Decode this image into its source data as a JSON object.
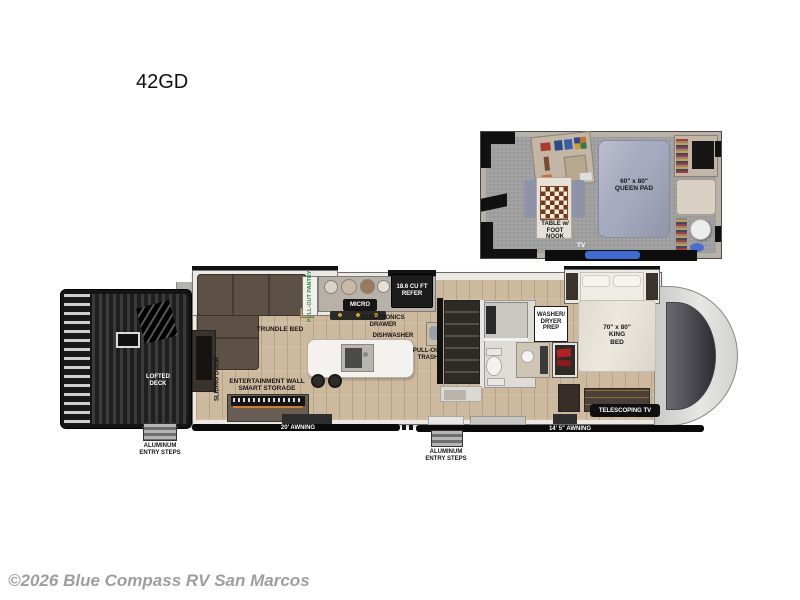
{
  "page": {
    "title": "42GD",
    "watermark": "©2026 Blue Compass RV San Marcos"
  },
  "loft": {
    "queen_pad": "60\" x 80\"\nQUEEN PAD",
    "table_nook": "TABLE w/\nFOOT\nNOOK",
    "tv": "TV"
  },
  "main": {
    "lofted_deck": "LOFTED\nDECK",
    "left_entry_steps": "ALUMINUM\nENTRY STEPS",
    "trundle_bed": "TRUNDLE BED",
    "pantry": "PULL-OUT PANTRY",
    "micro": "MICRO",
    "refrigerator": "18.6 CU FT\nREFER",
    "electronics_drawer": "ELECTRONICS\nDRAWER",
    "dishwasher": "DISHWASHER",
    "pull_out_trash": "PULL-OUT\nTRASH",
    "entertainment_wall": "ENTERTAINMENT WALL\nSMART STORAGE",
    "sliding_door": "SLIDING DOOR",
    "washer_dryer": "WASHER/\nDRYER\nPREP",
    "king_bed": "70\" x 80\"\nKING\nBED",
    "telescoping_tv": "TELESCOPING TV",
    "awning_front": "20' AWNING",
    "awning_rear": "14' 5\" AWNING",
    "center_entry_steps": "ALUMINUM\nENTRY STEPS"
  },
  "colors": {
    "pantry_text": "#2f8a3a",
    "loft_tv_accent": "#3e6bd6",
    "wood_floor": "#cdb99e",
    "carpet": "#9c9c9c"
  }
}
